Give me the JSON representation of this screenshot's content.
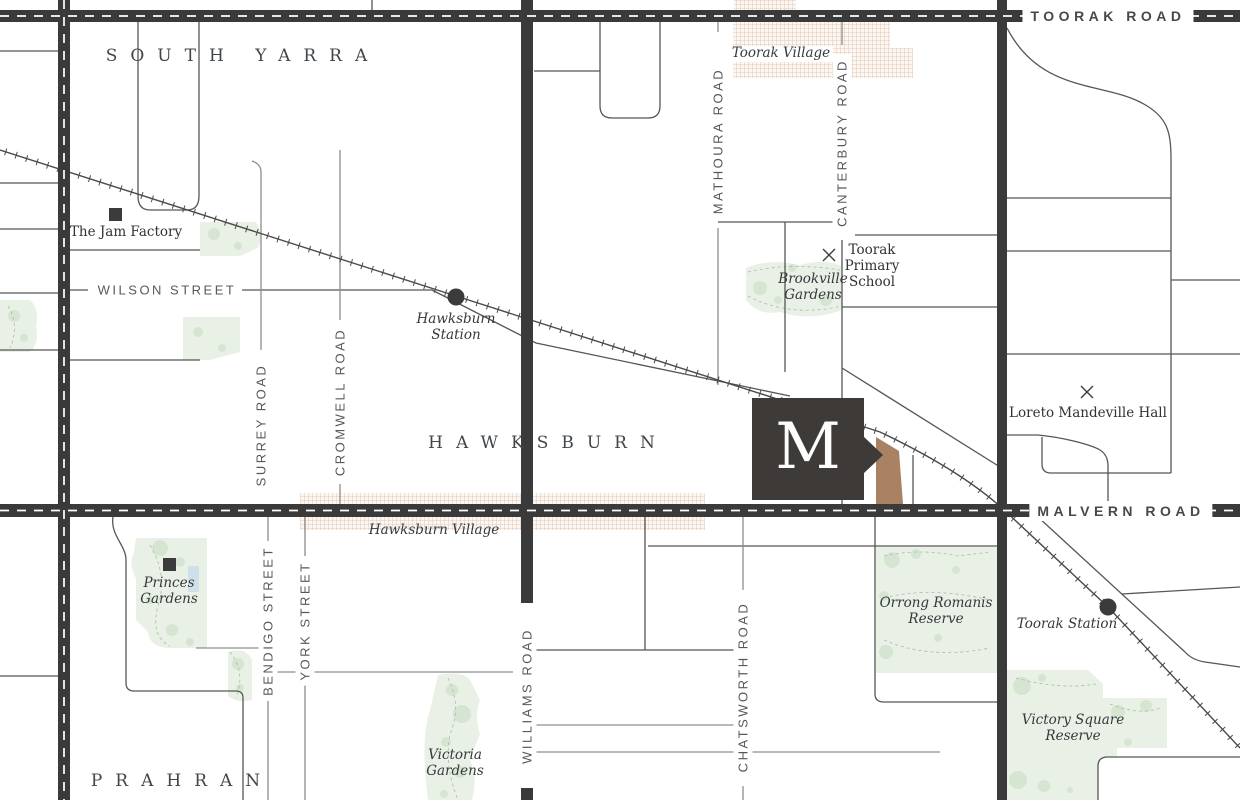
{
  "map": {
    "areas": {
      "south_yarra": "SOUTH YARRA",
      "hawksburn": "HAWKSBURN",
      "prahran": "PRAHRAN"
    },
    "roads": {
      "toorak": "TOORAK ROAD",
      "malvern": "MALVERN ROAD",
      "williams": "WILLIAMS ROAD",
      "wilson": "WILSON STREET",
      "surrey": "SURREY ROAD",
      "cromwell": "CROMWELL ROAD",
      "mathoura": "MATHOURA ROAD",
      "canterbury": "CANTERBURY ROAD",
      "bendigo": "BENDIGO STREET",
      "york": "YORK STREET",
      "chatsworth": "CHATSWORTH ROAD"
    },
    "villages": {
      "toorak_village": "Toorak Village",
      "hawksburn_village": "Hawksburn Village"
    },
    "parks": {
      "brookville": {
        "lines": [
          "Brookville",
          "Gardens"
        ]
      },
      "princes": {
        "lines": [
          "Princes",
          "Gardens"
        ]
      },
      "victoria": {
        "lines": [
          "Victoria",
          "Gardens"
        ]
      },
      "orrong": {
        "lines": [
          "Orrong Romanis",
          "Reserve"
        ]
      },
      "victory": {
        "lines": [
          "Victory Square",
          "Reserve"
        ]
      }
    },
    "stations": {
      "hawksburn": {
        "lines": [
          "Hawksburn",
          "Station"
        ]
      },
      "toorak": {
        "label": "Toorak Station"
      }
    },
    "landmarks": {
      "jam_factory": "The Jam Factory",
      "toorak_primary": {
        "lines": [
          "Toorak",
          "Primary",
          "School"
        ]
      },
      "loreto": "Loreto Mandeville Hall"
    },
    "logo": {
      "letter": "M"
    },
    "icons": {
      "station_dot": "filled-circle",
      "landmark_square": "filled-square",
      "school_cross": "x-mark",
      "logo_pointer": "right-triangle"
    },
    "colors": {
      "road_dark": "#3a3a3a",
      "street": "#5a5a5a",
      "street_light": "#8d8d8d",
      "park": "#e9f0e6",
      "park_blob": "#cddfc8",
      "hatch": "#d9b9a5",
      "text_dark": "#3b3f43",
      "logo_bg": "#3e3a38",
      "site_brown": "#a98263",
      "water": "#cfe0ea"
    }
  }
}
